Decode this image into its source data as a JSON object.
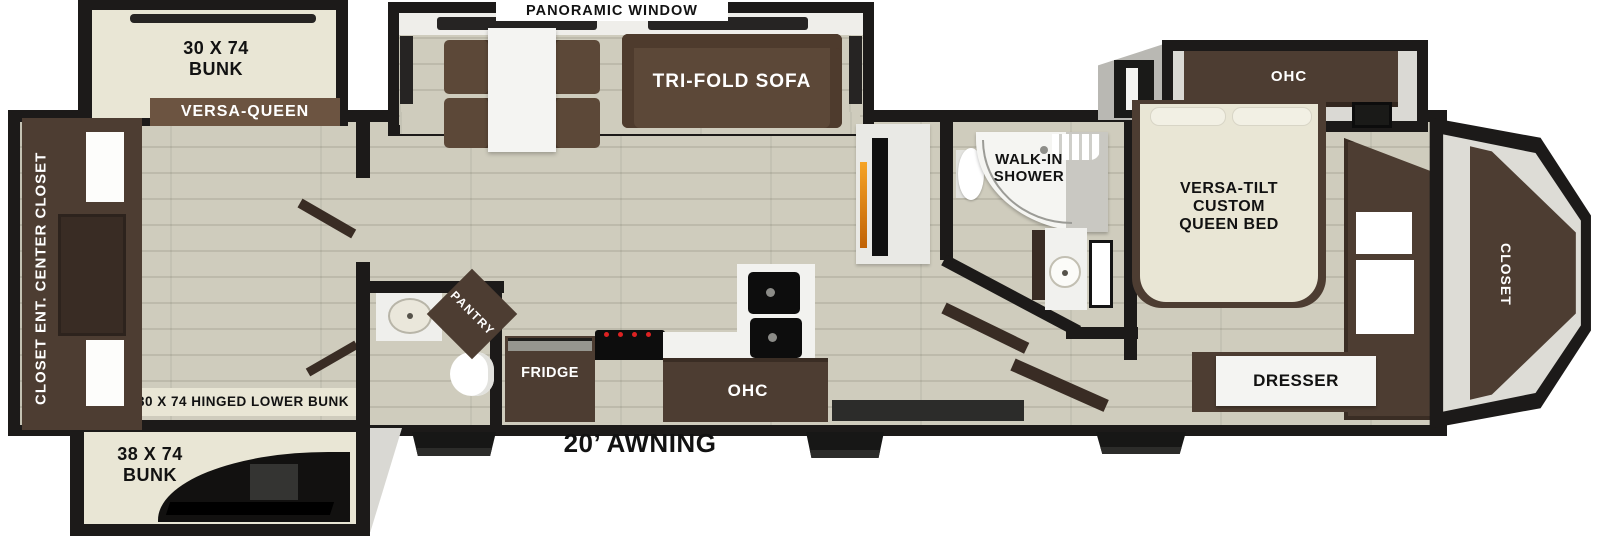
{
  "title": "Fifth-wheel RV floor plan",
  "labels": {
    "panoramic_window": "PANORAMIC WINDOW",
    "bunk_top": "30 X 74\nBUNK",
    "versa_queen": "VERSA-QUEEN",
    "rear_wall_unit": "CLOSET  ENT. CENTER  CLOSET",
    "hinged_lower_bunk": "30 X 74 HINGED LOWER BUNK",
    "bunk_bottom": "38 X 74\nBUNK",
    "tri_fold_sofa": "TRI-FOLD SOFA",
    "pantry": "PANTRY",
    "fridge": "FRIDGE",
    "kitchen_ohc": "OHC",
    "awning": "20’ AWNING",
    "walk_in_shower": "WALK-IN\nSHOWER",
    "bedroom_ohc": "OHC",
    "queen_bed": "VERSA-TILT\nCUSTOM\nQUEEN BED",
    "dresser": "DRESSER",
    "front_closet": "CLOSET"
  },
  "colors": {
    "wall": "#1c1a19",
    "floor": "#cfccbd",
    "floorline": "#bdbaab",
    "mattress": "#e9e6d5",
    "cabinet": "#4d3d32",
    "cabdark": "#392c24",
    "sofa": "#5c4838",
    "bar": "#6c5441",
    "white": "#f2f2ef",
    "graywall": "#c9c8c2",
    "fire": "#e88f1d",
    "window": "#262423",
    "ink": "#121212"
  }
}
